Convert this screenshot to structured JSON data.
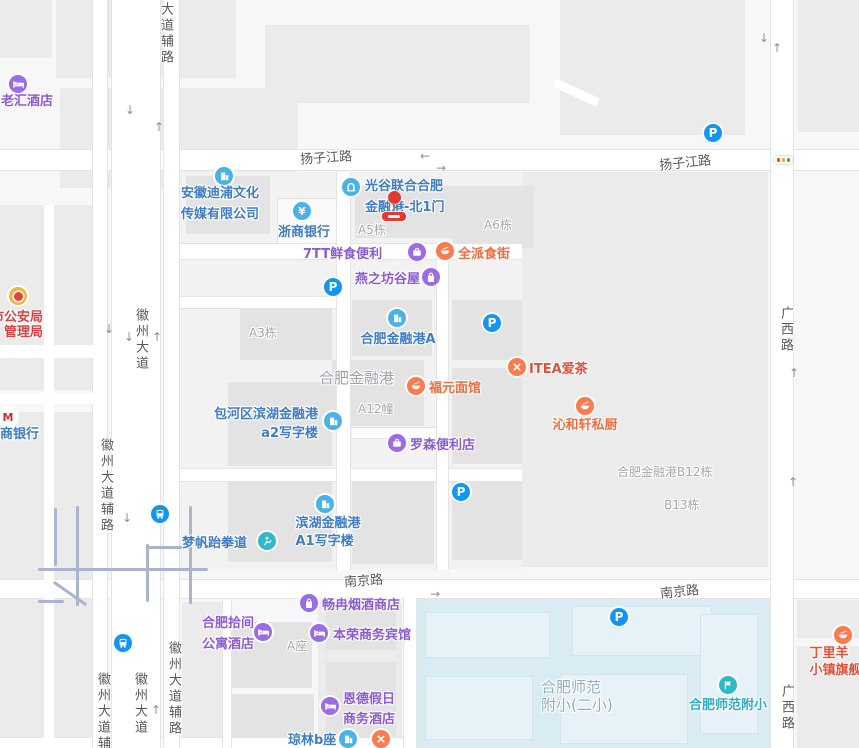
{
  "colors": {
    "purple": "#8A5BD3",
    "blue": "#3E7CC8",
    "orange": "#EF6C3F",
    "redOrange": "#E2503C",
    "red": "#D94040",
    "teal": "#2BAEC2",
    "gray": "#A7A7A7",
    "grayArea": "#9CA2A8",
    "schoolGray": "#8FAFBA",
    "iconPurple": "#9C6CE4",
    "iconCyan": "#49B2E8",
    "iconOrange": "#FB7B4E",
    "iconTeal": "#2FB9C9",
    "iconBlue": "#1196F5",
    "police": "#F2B53D",
    "cmbRed": "#C8312B",
    "roadLabel": "#595959"
  },
  "road_labels": [
    {
      "text": "扬子江路",
      "x": 300,
      "y": 147,
      "rot": -4
    },
    {
      "text": "扬子江路",
      "x": 659,
      "y": 152,
      "rot": -6
    },
    {
      "text": "南京路",
      "x": 344,
      "y": 570,
      "rot": -4
    },
    {
      "text": "南京路",
      "x": 660,
      "y": 581,
      "rot": -6
    },
    {
      "text": "徽州大道辅路",
      "x": 163,
      "y": -30,
      "v": true
    },
    {
      "text": "徽州大道",
      "x": 138,
      "y": 308,
      "v": true
    },
    {
      "text": "徽州大道辅路",
      "x": 103,
      "y": 438,
      "v": true
    },
    {
      "text": "徽州大道辅路",
      "x": 100,
      "y": 672,
      "v": true
    },
    {
      "text": "徽州大道",
      "x": 137,
      "y": 672,
      "v": true
    },
    {
      "text": "徽州大道辅路",
      "x": 171,
      "y": 641,
      "v": true
    },
    {
      "text": "广西路",
      "x": 783,
      "y": 306,
      "v": true
    },
    {
      "text": "广西路",
      "x": 784,
      "y": 684,
      "v": true
    }
  ],
  "pois": [
    {
      "id": "laohui-hotel",
      "icon": {
        "type": "hotel",
        "x": 18,
        "y": 84
      },
      "text": {
        "lines": [
          "老汇酒店"
        ],
        "x": 1,
        "y": 92,
        "align": "left",
        "color": "purple"
      }
    },
    {
      "id": "anhui-dipu-media",
      "icon": {
        "type": "building",
        "x": 224,
        "y": 176
      },
      "text": {
        "lines": [
          "安徽迪浦文化",
          "传媒有限公司"
        ],
        "x": 181,
        "y": 183,
        "align": "left",
        "color": "blue",
        "lh": 21
      }
    },
    {
      "id": "zheshang-bank",
      "icon": {
        "type": "bank",
        "glyph": "¥",
        "x": 302,
        "y": 211
      },
      "text": {
        "lines": [
          "浙商银行"
        ],
        "x": 304,
        "y": 223,
        "align": "center",
        "color": "blue"
      }
    },
    {
      "id": "guanggu-north-gate-1",
      "icon": {
        "type": "gate",
        "x": 351,
        "y": 187
      },
      "text": {
        "lines": [
          "光谷联合合肥",
          "金融港-北1门"
        ],
        "x": 365,
        "y": 176,
        "align": "left",
        "color": "blue",
        "lh": 21
      }
    },
    {
      "id": "bldg-a5",
      "text": {
        "lines": [
          "A5栋"
        ],
        "x": 358,
        "y": 221,
        "align": "left",
        "color": "gray",
        "size": 12,
        "weight": 400
      }
    },
    {
      "id": "bldg-a6",
      "text": {
        "lines": [
          "A6栋"
        ],
        "x": 484,
        "y": 216,
        "align": "left",
        "color": "gray",
        "size": 12,
        "weight": 400
      }
    },
    {
      "id": "7tt-fresh-store",
      "icon": {
        "type": "case",
        "x": 417,
        "y": 252
      },
      "text": {
        "lines": [
          "7TT鲜食便利"
        ],
        "x": 303,
        "y": 245,
        "align": "left",
        "color": "purple"
      }
    },
    {
      "id": "quanpai-food-street",
      "icon": {
        "type": "dish",
        "x": 445,
        "y": 251
      },
      "text": {
        "lines": [
          "全派食街"
        ],
        "x": 458,
        "y": 245,
        "align": "left",
        "color": "orange"
      }
    },
    {
      "id": "yanzhifang-guwu",
      "icon": {
        "type": "bag",
        "x": 431,
        "y": 277
      },
      "text": {
        "lines": [
          "燕之坊谷屋"
        ],
        "x": 355,
        "y": 270,
        "align": "left",
        "color": "purple"
      }
    },
    {
      "id": "hefei-jinronggang-a",
      "icon": {
        "type": "building",
        "x": 397,
        "y": 318
      },
      "text": {
        "lines": [
          "合肥金融港A"
        ],
        "x": 398,
        "y": 330,
        "align": "center",
        "color": "blue"
      }
    },
    {
      "id": "area-hefei-jinronggang",
      "text": {
        "lines": [
          "合肥金融港"
        ],
        "x": 319,
        "y": 369,
        "align": "left",
        "color": "grayArea",
        "size": 15,
        "weight": 400
      }
    },
    {
      "id": "bldg-a3",
      "text": {
        "lines": [
          "A3栋"
        ],
        "x": 249,
        "y": 324,
        "align": "left",
        "color": "gray",
        "size": 12,
        "weight": 400
      }
    },
    {
      "id": "fuyuan-noodle",
      "icon": {
        "type": "bowl",
        "x": 416,
        "y": 386
      },
      "text": {
        "lines": [
          "福元面馆"
        ],
        "x": 429,
        "y": 379,
        "align": "left",
        "color": "orange"
      }
    },
    {
      "id": "itea-aicha",
      "icon": {
        "type": "fork",
        "x": 517,
        "y": 367
      },
      "text": {
        "lines": [
          "ITEA爱茶"
        ],
        "x": 529,
        "y": 360,
        "align": "left",
        "color": "redOrange"
      }
    },
    {
      "id": "qinhexuan-kitchen",
      "icon": {
        "type": "bowl",
        "x": 585,
        "y": 406
      },
      "text": {
        "lines": [
          "沁和轩私厨"
        ],
        "x": 585,
        "y": 416,
        "align": "center",
        "color": "orange"
      }
    },
    {
      "id": "bldg-a12",
      "text": {
        "lines": [
          "A12幢"
        ],
        "x": 358,
        "y": 400,
        "align": "left",
        "color": "gray",
        "size": 12,
        "weight": 400
      }
    },
    {
      "id": "baohe-binhu-a2",
      "icon": {
        "type": "building",
        "x": 333,
        "y": 421
      },
      "text": {
        "lines": [
          "包河区滨湖金融港",
          "a2写字楼"
        ],
        "x": 318,
        "y": 405,
        "align": "right",
        "color": "blue",
        "lh": 19
      }
    },
    {
      "id": "lawson-store",
      "icon": {
        "type": "case",
        "x": 397,
        "y": 443
      },
      "text": {
        "lines": [
          "罗森便利店"
        ],
        "x": 410,
        "y": 436,
        "align": "left",
        "color": "purple"
      }
    },
    {
      "id": "bldg-b12",
      "text": {
        "lines": [
          "合肥金融港B12栋"
        ],
        "x": 617,
        "y": 463,
        "align": "left",
        "color": "gray",
        "size": 12,
        "weight": 400
      }
    },
    {
      "id": "bldg-b13",
      "text": {
        "lines": [
          "B13栋"
        ],
        "x": 664,
        "y": 496,
        "align": "left",
        "color": "gray",
        "size": 12,
        "weight": 400
      }
    },
    {
      "id": "binhu-jinronggang-a1",
      "icon": {
        "type": "building",
        "x": 325,
        "y": 504
      },
      "text": {
        "lines": [
          "滨湖金融港",
          "A1写字楼"
        ],
        "x": 328,
        "y": 515,
        "align": "center",
        "color": "blue",
        "lh": 18
      }
    },
    {
      "id": "mengfan-taekwondo",
      "icon": {
        "type": "sport",
        "x": 267,
        "y": 541
      },
      "text": {
        "lines": [
          "梦帆跆拳道"
        ],
        "x": 182,
        "y": 534,
        "align": "left",
        "color": "blue"
      }
    },
    {
      "id": "changran-tobacco-shop",
      "icon": {
        "type": "bag",
        "x": 309,
        "y": 603
      },
      "text": {
        "lines": [
          "畅冉烟酒商店"
        ],
        "x": 322,
        "y": 596,
        "align": "left",
        "color": "purple"
      }
    },
    {
      "id": "shijian-apartment-hotel",
      "icon": {
        "type": "hotel",
        "x": 263,
        "y": 632
      },
      "text": {
        "lines": [
          "合肥拾间",
          "公寓酒店"
        ],
        "x": 202,
        "y": 613,
        "align": "left",
        "color": "purple",
        "lh": 21
      }
    },
    {
      "id": "benrong-hotel",
      "icon": {
        "type": "hotel",
        "x": 319,
        "y": 633
      },
      "text": {
        "lines": [
          "本荣商务宾馆"
        ],
        "x": 333,
        "y": 626,
        "align": "left",
        "color": "purple"
      }
    },
    {
      "id": "bldg-a-zuo",
      "text": {
        "lines": [
          "A座"
        ],
        "x": 287,
        "y": 637,
        "align": "left",
        "color": "gray",
        "size": 12,
        "weight": 400
      }
    },
    {
      "id": "ende-holiday-hotel",
      "icon": {
        "type": "hotel",
        "x": 330,
        "y": 706
      },
      "text": {
        "lines": [
          "恩德假日",
          "商务酒店"
        ],
        "x": 343,
        "y": 690,
        "align": "left",
        "color": "purple",
        "lh": 20
      }
    },
    {
      "id": "qionglin-b-zuo",
      "icon": {
        "type": "building",
        "x": 348,
        "y": 739
      },
      "text": {
        "lines": [
          "琼林b座"
        ],
        "x": 288,
        "y": 731,
        "align": "left",
        "color": "blue"
      }
    },
    {
      "id": "restaurant-near-qionglin",
      "icon": {
        "type": "fork",
        "x": 381,
        "y": 739
      }
    },
    {
      "id": "area-shifan-fuxiao-2",
      "text": {
        "lines": [
          "合肥师范",
          "附小(二小)"
        ],
        "x": 541,
        "y": 678,
        "align": "left",
        "color": "schoolGray",
        "size": 15,
        "weight": 400,
        "lh": 18
      }
    },
    {
      "id": "hefei-shifan-fuxiao",
      "icon": {
        "type": "school",
        "x": 728,
        "y": 685
      },
      "text": {
        "lines": [
          "合肥师范附小"
        ],
        "x": 728,
        "y": 696,
        "align": "center",
        "color": "teal"
      }
    },
    {
      "id": "dingliyang-flagship",
      "icon": {
        "type": "bowl",
        "x": 843,
        "y": 635
      },
      "text": {
        "lines": [
          "丁里羊",
          "小镇旗舰店"
        ],
        "x": 842,
        "y": 645,
        "align": "center",
        "color": "redOrange",
        "lh": 17
      }
    },
    {
      "id": "public-security-bureau",
      "icon": {
        "type": "police",
        "x": 18,
        "y": 296
      },
      "text": {
        "lines": [
          "市公安局",
          "管理局"
        ],
        "x": 43,
        "y": 310,
        "align": "right",
        "color": "red",
        "lh": 15
      }
    },
    {
      "id": "cmb-bank",
      "icon": {
        "type": "cmb",
        "glyph": "M",
        "x": 8,
        "y": 417
      },
      "text": {
        "lines": [
          "商银行"
        ],
        "x": 0,
        "y": 425,
        "align": "left",
        "color": "blue"
      }
    }
  ],
  "map_symbols": {
    "parking_glyph": "P",
    "parking": [
      {
        "x": 333,
        "y": 287
      },
      {
        "x": 492,
        "y": 323
      },
      {
        "x": 713,
        "y": 133
      },
      {
        "x": 461,
        "y": 492
      },
      {
        "x": 619,
        "y": 617
      }
    ],
    "transit": [
      {
        "x": 160,
        "y": 514
      },
      {
        "x": 123,
        "y": 643
      }
    ],
    "traffic_light": {
      "x": 783,
      "y": 160
    },
    "arrows": [
      {
        "g": "↓",
        "x": 125,
        "y": 104
      },
      {
        "g": "↑",
        "x": 154,
        "y": 121
      },
      {
        "g": "←",
        "x": 420,
        "y": 150
      },
      {
        "g": "→",
        "x": 436,
        "y": 162
      },
      {
        "g": "↓",
        "x": 759,
        "y": 32
      },
      {
        "g": "↑",
        "x": 772,
        "y": 42
      },
      {
        "g": "↓",
        "x": 104,
        "y": 323
      },
      {
        "g": "↓",
        "x": 124,
        "y": 331
      },
      {
        "g": "↑",
        "x": 152,
        "y": 331
      },
      {
        "g": "→",
        "x": 430,
        "y": 588
      },
      {
        "g": "↑",
        "x": 789,
        "y": 367
      },
      {
        "g": "↑",
        "x": 788,
        "y": 476
      },
      {
        "g": "↓",
        "x": 122,
        "y": 512
      },
      {
        "g": "↑",
        "x": 151,
        "y": 704
      }
    ]
  },
  "marker": {
    "x": 394,
    "y": 197
  }
}
